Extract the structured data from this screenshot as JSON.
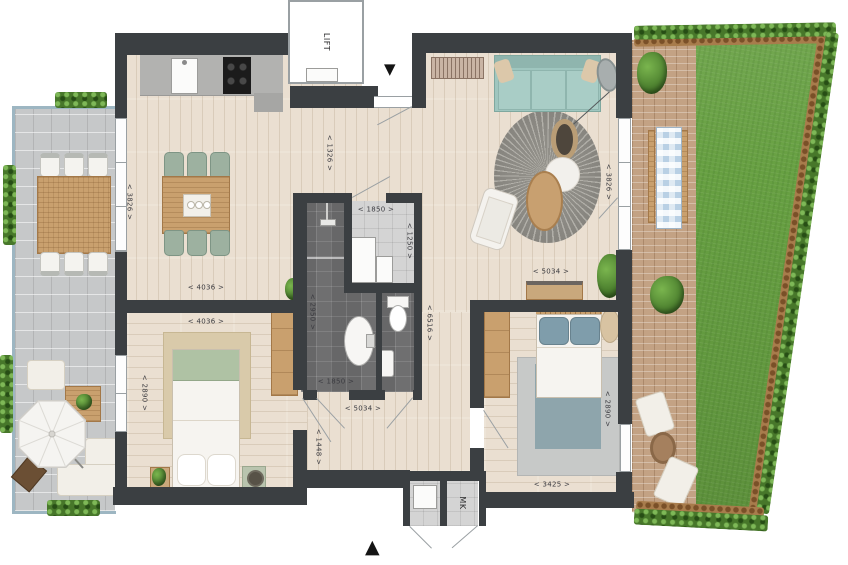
{
  "palette": {
    "wall": "#3b3f42",
    "wood_floor": "#eadfd1",
    "bathroom_tile": "#6f6f70",
    "utility_tile": "#d4d4d4",
    "terrace_tile": "#c6c8c9",
    "grass": "#67a042",
    "patio_brick": "#c3a284",
    "hedge_green": "#47772a",
    "sofa_teal": "#9fc6bf",
    "chair_sage": "#9db1a0",
    "bed_blue": "#7f9dab",
    "furniture_wood": "#c9a06e",
    "dimension_text": "#3b3b40"
  },
  "labels": {
    "lift": "LIFT",
    "meter_cupboard": "MK"
  },
  "icons": {
    "entry_arrow_down": "▼",
    "north_arrow_up": "▲"
  },
  "dimensions": [
    {
      "id": "entry-width",
      "text": "< 1326 >"
    },
    {
      "id": "dining-depth",
      "text": "< 3826 >"
    },
    {
      "id": "living-width-a",
      "text": "< 4036 >"
    },
    {
      "id": "bedroom1-width",
      "text": "< 4036 >"
    },
    {
      "id": "bedroom1-depth",
      "text": "< 2890 >"
    },
    {
      "id": "utility-width",
      "text": "< 1850 >"
    },
    {
      "id": "utility-depth",
      "text": "< 1250 >"
    },
    {
      "id": "bathroom-depth",
      "text": "< 2950 >"
    },
    {
      "id": "bathroom-width",
      "text": "< 1850 >"
    },
    {
      "id": "hall-width",
      "text": "< 5034 >"
    },
    {
      "id": "hall-depth",
      "text": "< 1448 >"
    },
    {
      "id": "corridor-depth",
      "text": "< 6516 >"
    },
    {
      "id": "living-width-b",
      "text": "< 5034 >"
    },
    {
      "id": "living-depth",
      "text": "< 3826 >"
    },
    {
      "id": "bedroom2-depth",
      "text": "< 2890 >"
    },
    {
      "id": "bedroom2-width",
      "text": "< 3425 >"
    }
  ]
}
